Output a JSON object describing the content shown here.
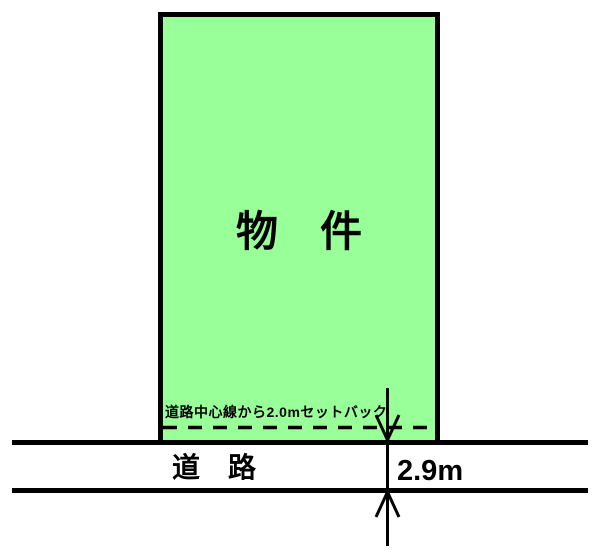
{
  "diagram": {
    "property": {
      "label": "物　件",
      "fill_color": "#99FF99",
      "border_color": "#000000"
    },
    "setback": {
      "note": "道路中心線から2.0mセットバック"
    },
    "road": {
      "label": "道　路",
      "width_label": "2.9m"
    },
    "colors": {
      "line": "#000000",
      "background": "#FFFFFF"
    }
  }
}
